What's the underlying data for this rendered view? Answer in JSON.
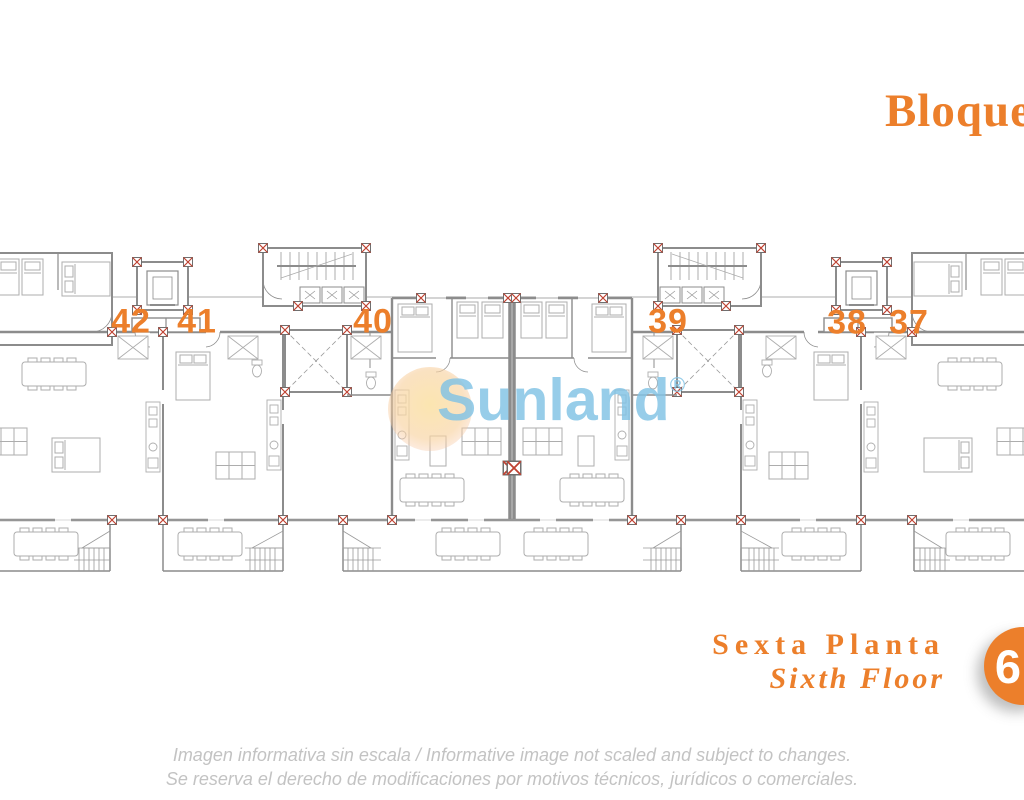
{
  "header": {
    "title": "Bloque"
  },
  "plan": {
    "units": [
      {
        "number": "42"
      },
      {
        "number": "41"
      },
      {
        "number": "40"
      },
      {
        "number": "39"
      },
      {
        "number": "38"
      },
      {
        "number": "37"
      }
    ],
    "watermark": {
      "text": "Sunland",
      "registered": "®"
    }
  },
  "floor": {
    "label_es": "Sexta Planta",
    "label_en": "Sixth Floor",
    "badge": "6"
  },
  "disclaimer": {
    "line1": "Imagen informativa sin escala /  Informative image not scaled and subject to changes.",
    "line2": "Se reserva el derecho de modificaciones por motivos técnicos, jurídicos o comerciales."
  },
  "colors": {
    "accent": "#EC7F2B",
    "plan_line": "#8C8C8C",
    "furniture_line": "#ADADAD",
    "column_red": "#BF4131",
    "watermark_blue": "#80C2E4",
    "watermark_sun": "#FBE4AC",
    "disclaimer_gray": "#C3C3C3",
    "badge_text": "#FFFFFF"
  }
}
